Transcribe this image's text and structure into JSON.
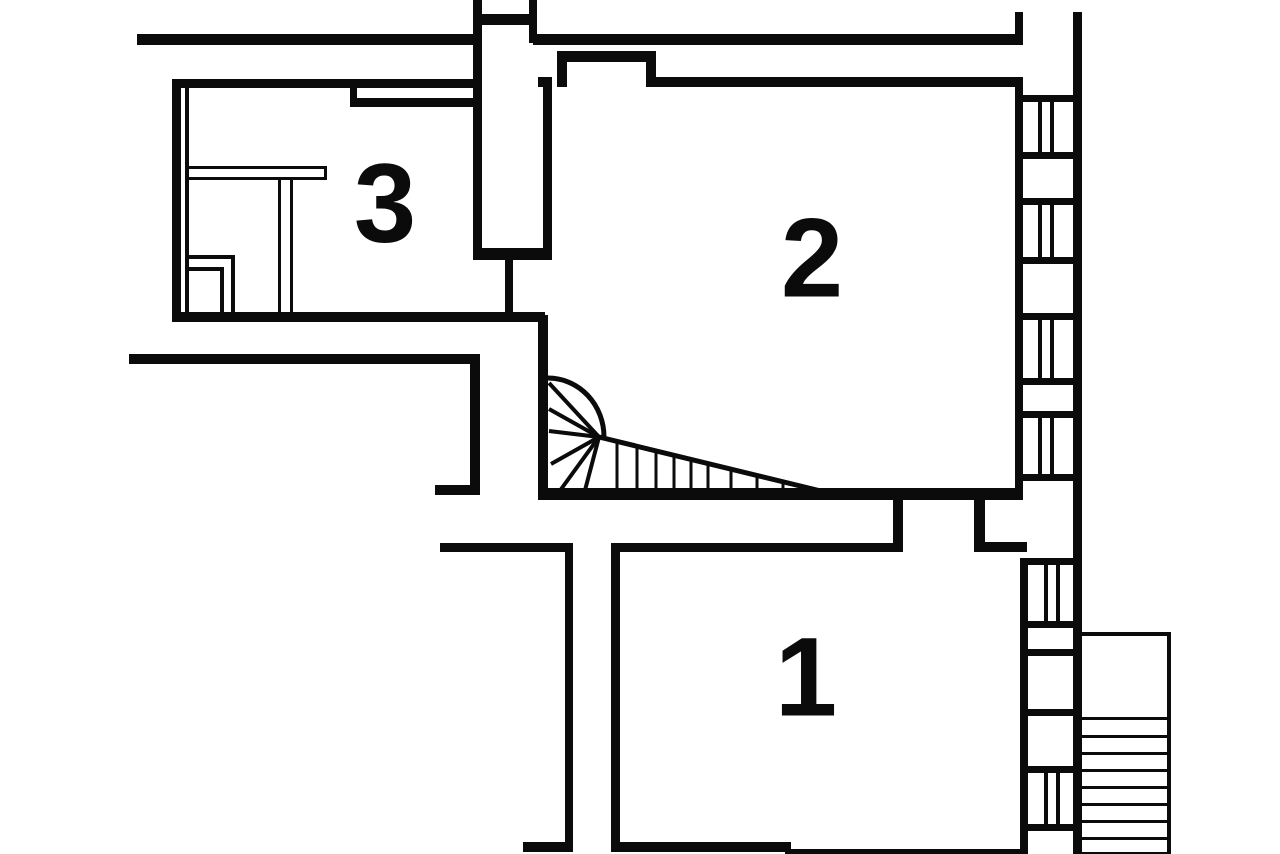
{
  "canvas": {
    "background_color": "#ffffff",
    "wall_color": "#0b0b0b"
  },
  "floorplan": {
    "kind": "black-and-white architectural floor plan",
    "rooms": [
      {
        "label": "1"
      },
      {
        "label": "2"
      },
      {
        "label": "3"
      }
    ]
  }
}
